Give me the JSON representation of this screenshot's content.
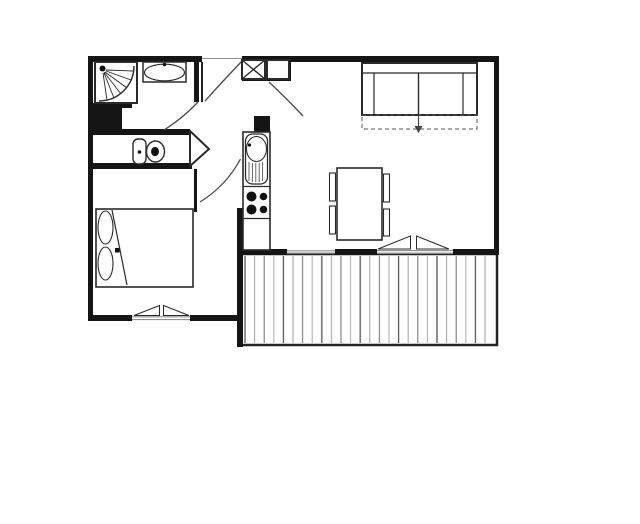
{
  "document": {
    "type": "floor-plan",
    "title": "Studio apartment floor plan",
    "style": "black-and-white line drawing, no text labels"
  },
  "palette": {
    "background": "#ffffff",
    "wall": "#151515",
    "furniture_line": "#2a2a2a",
    "door_line": "#4a4a4a",
    "window_line": "#8f8f8f",
    "deck_line_dark": "#555555",
    "deck_line_light": "#9e9e9e"
  },
  "rooms": [
    {
      "id": "bathroom",
      "name": "bathroom",
      "fixtures": [
        "corner-shower",
        "washbasin"
      ]
    },
    {
      "id": "wc",
      "name": "wc",
      "fixtures": [
        "toilet-cistern",
        "toilet-bowl"
      ]
    },
    {
      "id": "entry-hall",
      "name": "entry-hall",
      "fixtures": [
        "entry-door",
        "duct-shaft-crossed-box",
        "storage-box"
      ]
    },
    {
      "id": "kitchen",
      "name": "kitchenette",
      "fixtures": [
        "sink-unit",
        "cooktop",
        "base-counter"
      ]
    },
    {
      "id": "living-room",
      "name": "living-room",
      "fixtures": [
        "sofa-bed",
        "pull-out-dashed-outline",
        "dining-table",
        "chairs",
        "sliding-window"
      ]
    },
    {
      "id": "bedroom",
      "name": "bedroom",
      "fixtures": [
        "double-bed",
        "pillows",
        "window"
      ]
    },
    {
      "id": "balcony",
      "name": "balcony",
      "fixtures": [
        "deck-planks"
      ]
    }
  ],
  "counts": {
    "cooktop_burners": 4,
    "dining_chairs": 4,
    "pillows": 2,
    "sofa_seats": 2,
    "doors_drawn": 5,
    "windows_drawn": 3
  },
  "symbols": {
    "pull_out_arrow": "downward arrow inside dashed rectangle below sofa",
    "shower_spray": "radiating lines from shower head dot in corner cabin",
    "crossed_box": "square with X diagonals near entry (duct/shaft)"
  }
}
